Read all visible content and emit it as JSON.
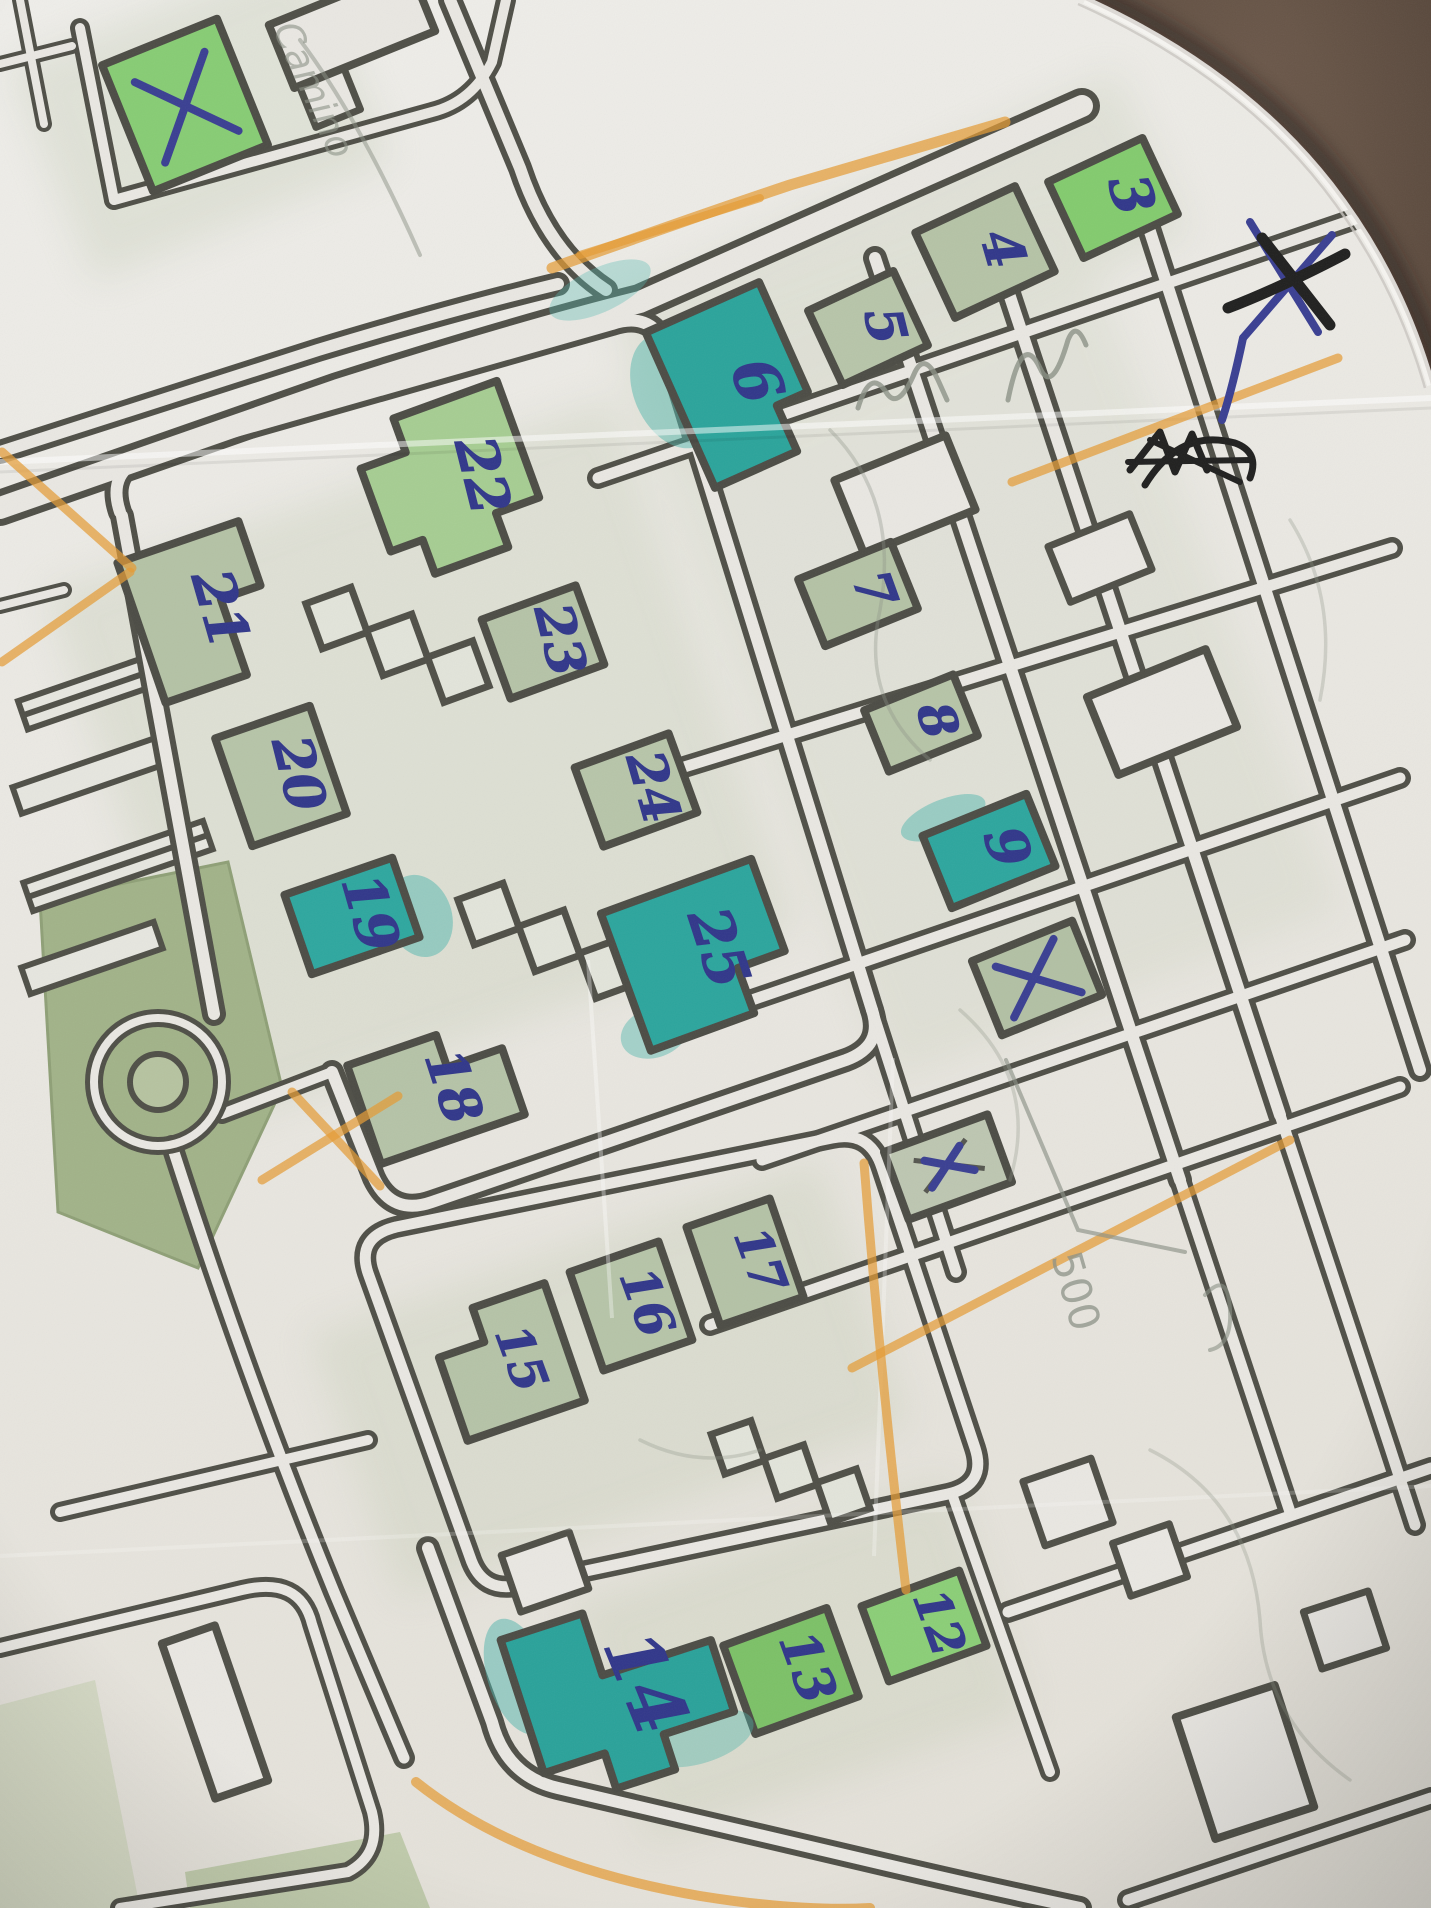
{
  "scene": {
    "description": "Photograph of a folded printed street map annotated by hand with an orienteering course",
    "surface": "dark brown leather",
    "paper": "white printed map sheet with crease and curved top-right edge"
  },
  "colors": {
    "ballpoint_blue": "#31378a",
    "black_pen": "#20201f",
    "orange_highlighter": "#e59b35",
    "teal_highlighter": "#2ca59d",
    "building_green": "#b5c3a7",
    "bright_green": "#85cb71",
    "road_casing": "#4f4f47",
    "paper": "#ecebe5",
    "leather": "#46382d",
    "pencil": "#8b9186"
  },
  "map": {
    "numbers": [
      {
        "value": "3",
        "marker": "green"
      },
      {
        "value": "4",
        "marker": "none"
      },
      {
        "value": "5",
        "marker": "none"
      },
      {
        "value": "6",
        "marker": "teal"
      },
      {
        "value": "7",
        "marker": "none"
      },
      {
        "value": "8",
        "marker": "none"
      },
      {
        "value": "9",
        "marker": "teal"
      },
      {
        "value": "12",
        "marker": "green"
      },
      {
        "value": "13",
        "marker": "green"
      },
      {
        "value": "14",
        "marker": "teal"
      },
      {
        "value": "15",
        "marker": "none"
      },
      {
        "value": "16",
        "marker": "none"
      },
      {
        "value": "17",
        "marker": "none"
      },
      {
        "value": "18",
        "marker": "none"
      },
      {
        "value": "19",
        "marker": "teal"
      },
      {
        "value": "20",
        "marker": "none"
      },
      {
        "value": "21",
        "marker": "none"
      },
      {
        "value": "22",
        "marker": "none"
      },
      {
        "value": "23",
        "marker": "none"
      },
      {
        "value": "24",
        "marker": "none"
      },
      {
        "value": "25",
        "marker": "teal"
      }
    ],
    "x_marks": [
      "green building top-left",
      "paper corner top-right, blue pen crossed again in black pen",
      "building below number 9",
      "small building mid-right"
    ],
    "pencil_notes": {
      "word": "Camino",
      "distance": "500"
    }
  }
}
